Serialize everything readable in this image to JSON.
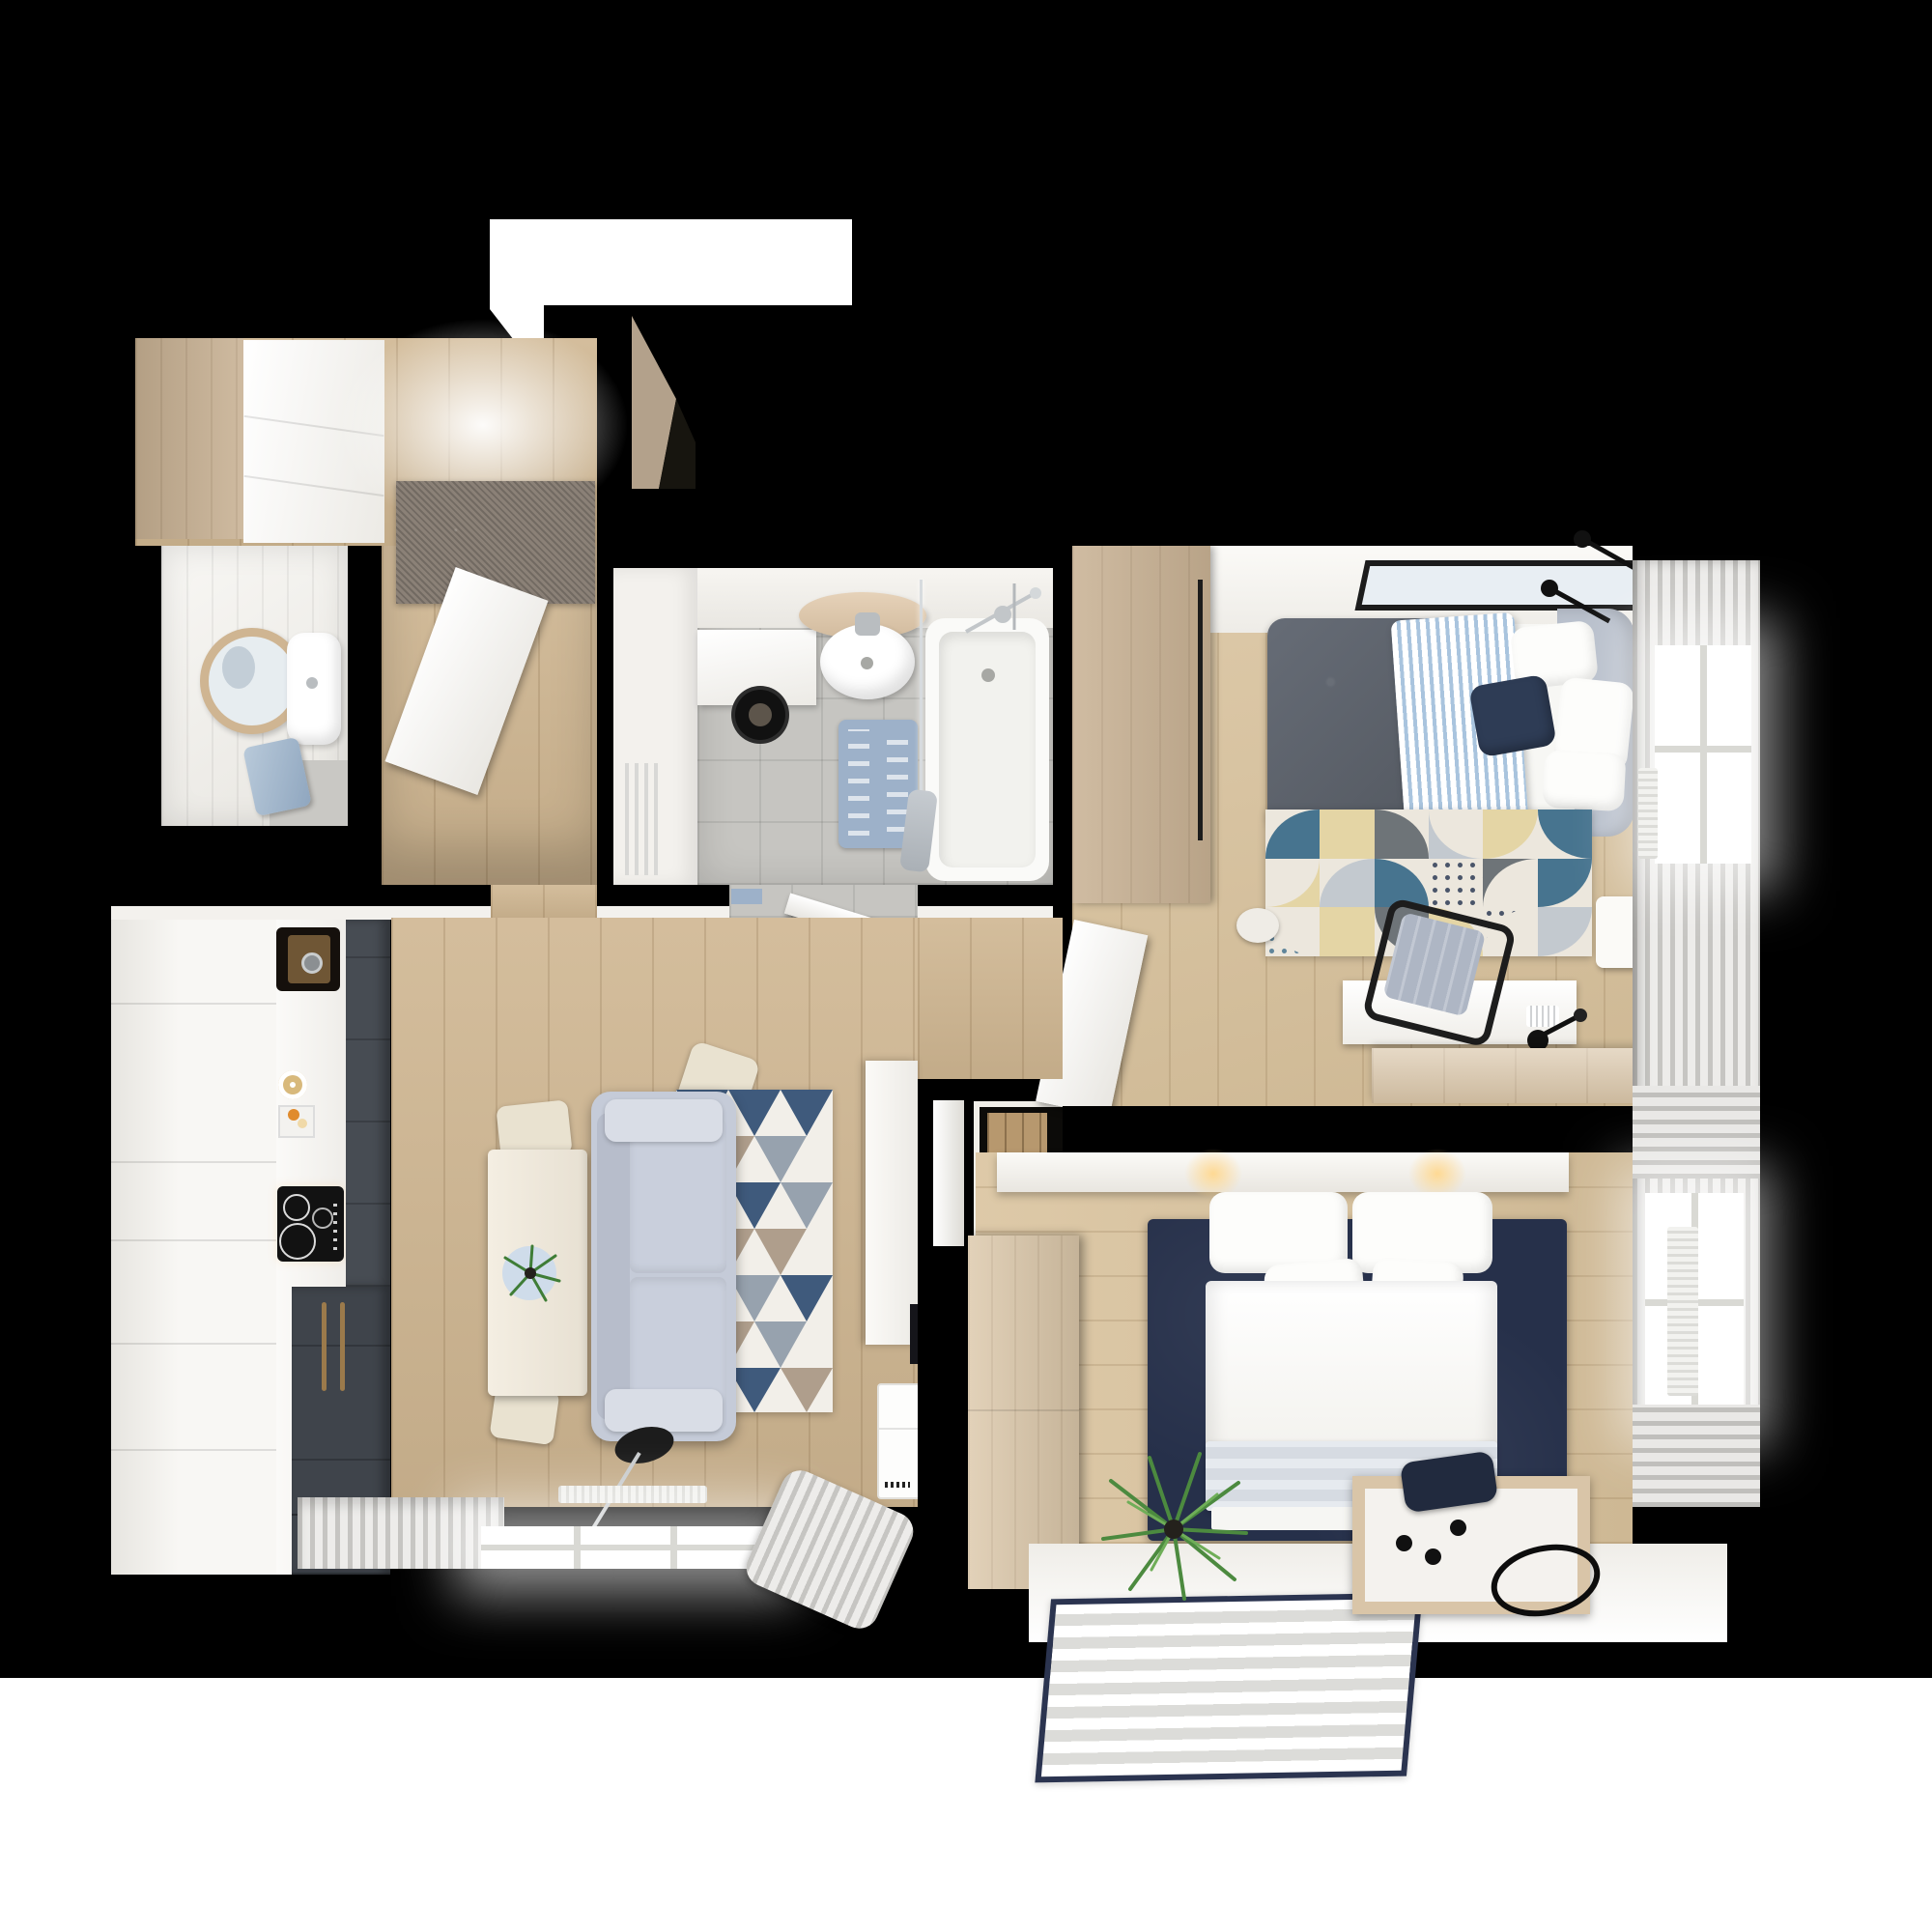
{
  "scene": {
    "type": "3d-rendered apartment floor plan, top-down view",
    "visible_text": "none",
    "background_color": "#000000",
    "bottom_band_color": "#ffffff"
  },
  "palette": {
    "walls": "#000000",
    "wood_floor": "#cfb691",
    "bedroom_floor": "#d9c29c",
    "white_surfaces": "#f3f1ed",
    "bath_tile": "#c6c5c1",
    "kitchen_graphite": "#474c53",
    "brass_accent": "#9b7a4b",
    "navy_rug": "#26304a",
    "sofa_gray": "#c5cbd8",
    "triangle_rug_blue": "#3f5a7c",
    "geo_rug_teal": "#47748f",
    "geo_rug_sand": "#e4d5a5",
    "entry_door_beige": "#b3a18b",
    "bath_mat_blue": "#9db1c9"
  },
  "labels": {
    "plan": "apartment floor plan render",
    "entry_lightwell": "entrance landing light",
    "entry_door": "open entrance door",
    "hall": "entrance hall",
    "hall_wardrobe": "hall wardrobe",
    "hall_cabinet": "hall white cabinet",
    "hall_rug": "gray doormat rug",
    "hall_door": "open white interior door",
    "bath_small": "small washroom",
    "mirror": "round mirror",
    "small_sink": "wall-hung sink",
    "towel": "blue towel",
    "bath_main": "bathroom",
    "towel_radiator": "towel radiator",
    "washer": "washing machine under counter",
    "bath_sink": "round sink with wooden shelf",
    "toilet": "toilet",
    "bath_mat": "blue bath mat",
    "bathtub": "bathtub with shower screen",
    "bath_door": "open bathroom door",
    "bedroom1": "bedroom with gray bed",
    "bed1_wardrobe": "bedroom wardrobe",
    "picture_frame": "wall picture",
    "wall_lamps": "black wall lamps",
    "bed1": "double bed with gray duvet and striped blanket",
    "geo_rug": "geometric pattern rug",
    "desk": "white desk with keyboard",
    "desk_chair": "office chair",
    "sideboard1": "wooden sideboard",
    "nightstand": "nightstand",
    "window1": "bedroom window with curtains",
    "nook": "bedroom entry nook",
    "bedroom2": "bedroom with white bed",
    "headboard_shelf": "headboard shelf with lamps",
    "bed2": "double bed with white bedding",
    "navy_rug": "navy area rug",
    "dresser2": "wooden dresser",
    "plant2": "potted plant",
    "bench2": "wooden storage box",
    "cable_oval": "oval cord on floor",
    "sill_mat": "striped mat with navy border",
    "window2": "bedroom window with radiator",
    "living": "open living room with kitchen",
    "kitchen_cabinets": "white kitchen cabinets",
    "kitchen_sink": "black composite sink",
    "breakfast": "breakfast set on counter",
    "cooktop": "induction cooktop",
    "tall_units": "graphite tall units with brass handles",
    "dining_table": "dining table",
    "table_plant": "plant on blue plate",
    "chair": "cream dining chair",
    "sofa": "gray sofa",
    "triangle_rug": "triangle pattern rug",
    "floor_lamp": "black floor lamp",
    "living_radiator": "radiator",
    "living_window": "living room window with curtains",
    "tv_console": "white media wall",
    "devices": "air purifier units",
    "page_band": "white page edge"
  }
}
